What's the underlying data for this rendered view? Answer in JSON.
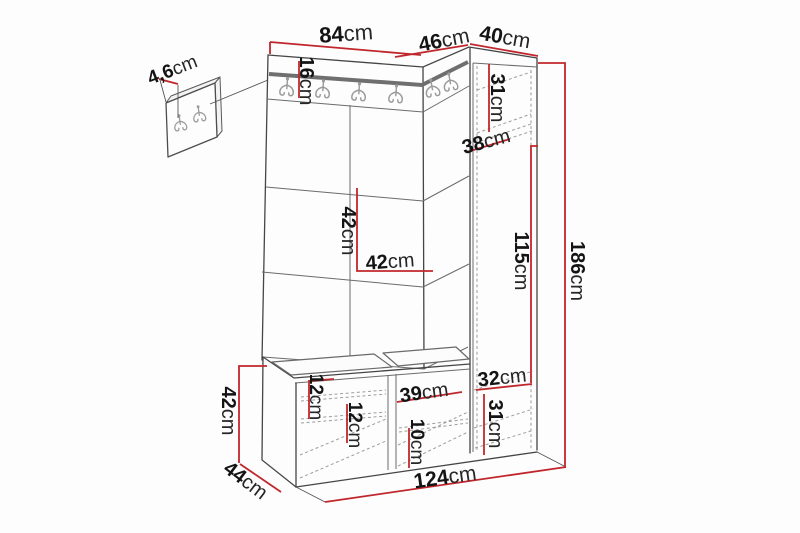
{
  "diagram": {
    "type": "furniture-dimension-diagram",
    "subject": "hallway unit with mini hook panel, upholstered wall panels, coat hooks, tall cabinet and shoe bench",
    "unit": "cm",
    "icons": {
      "coat_hook": "coat-hook-icon"
    },
    "colors": {
      "dimension_line": "#c0272d",
      "outline": "#454545",
      "rail": "#6f6f6f",
      "hooks": "#9b9b9b",
      "background": "#fdfdfd"
    },
    "dimensions": {
      "mini_panel_thickness": {
        "value": "4,6",
        "unit": "cm"
      },
      "top_width_main": {
        "value": "84",
        "unit": "cm"
      },
      "top_width_corner": {
        "value": "46",
        "unit": "cm"
      },
      "top_width_cabinet": {
        "value": "40",
        "unit": "cm"
      },
      "hook_rail_height": {
        "value": "16",
        "unit": "cm"
      },
      "cabinet_top_height": {
        "value": "31",
        "unit": "cm"
      },
      "cabinet_depth": {
        "value": "38",
        "unit": "cm"
      },
      "panel_tile_height": {
        "value": "42",
        "unit": "cm"
      },
      "panel_tile_width": {
        "value": "42",
        "unit": "cm"
      },
      "cabinet_mid_height": {
        "value": "115",
        "unit": "cm"
      },
      "total_height": {
        "value": "186",
        "unit": "cm"
      },
      "cabinet_lower_width": {
        "value": "32",
        "unit": "cm"
      },
      "cabinet_lower_height": {
        "value": "31",
        "unit": "cm"
      },
      "bench_gap_upper": {
        "value": "12",
        "unit": "cm"
      },
      "bench_gap_lower": {
        "value": "12",
        "unit": "cm"
      },
      "bench_compartment_width": {
        "value": "39",
        "unit": "cm"
      },
      "bench_gap_right": {
        "value": "10",
        "unit": "cm"
      },
      "bench_height": {
        "value": "42",
        "unit": "cm"
      },
      "bench_depth": {
        "value": "44",
        "unit": "cm"
      },
      "total_width": {
        "value": "124",
        "unit": "cm"
      }
    }
  }
}
